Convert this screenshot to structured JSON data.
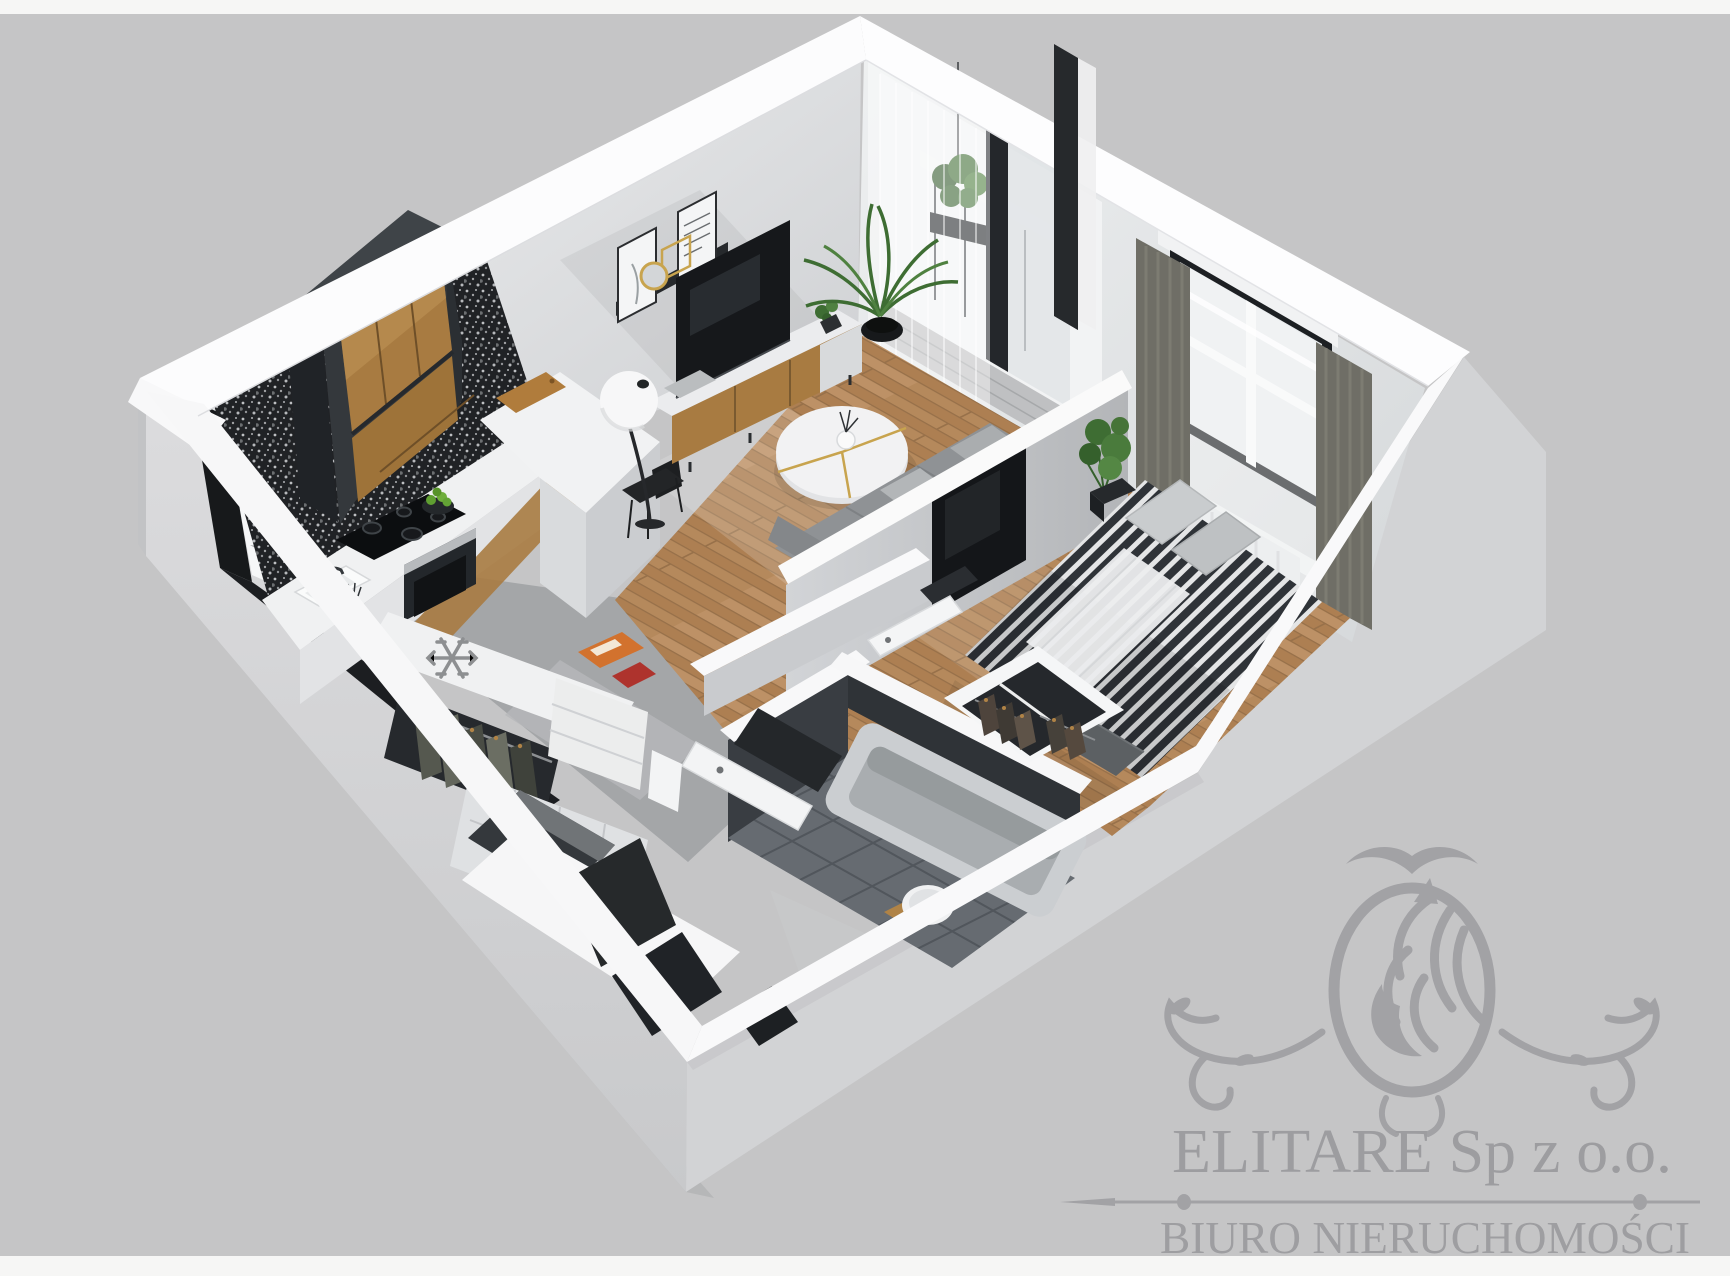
{
  "watermark": {
    "company": "ELITARE Sp z o.o.",
    "subtitle": "BIURO NIERUCHOMOŚCI",
    "emblem": "lion-crest-emblem",
    "text_color": "#97979a"
  },
  "scene": {
    "type": "3d-apartment-floor-plan-render",
    "view": "isometric-cutaway",
    "background_color": "#c5c5c6",
    "rooms": [
      {
        "name": "living-room-with-kitchenette",
        "floor": "oak-plank",
        "items": [
          "charcoal-oak-upper-cabinets",
          "patterned-tile-backsplash",
          "induction-cooktop",
          "built-in-oven",
          "kitchen-sink",
          "freezer-snowflake-marker",
          "kitchen-peninsula",
          "cutting-board",
          "fruit-bowl",
          "bar-chairs",
          "wall-shelf-with-posters",
          "round-gold-mirror",
          "tv",
          "tv-media-console",
          "sphere-floor-lamp",
          "round-coffee-table",
          "corner-sofa",
          "palm-plant",
          "balcony-door",
          "sheer-curtains"
        ]
      },
      {
        "name": "balcony",
        "floor": "gray-tile",
        "items": [
          "hanging-plant",
          "railing",
          "glass-door-frame"
        ]
      },
      {
        "name": "bedroom",
        "floor": "oak-plank",
        "items": [
          "double-bed-striped-duvet",
          "pillows",
          "white-folded-blanket",
          "foot-bench",
          "open-wardrobe-with-clothes",
          "wall-mounted-tv",
          "window-with-curtains",
          "monstera-plant",
          "radiator"
        ]
      },
      {
        "name": "bathroom",
        "floor": "dark-gray-tile",
        "items": [
          "bathtub",
          "round-washbasin",
          "wood-stool",
          "bathroom-door"
        ]
      },
      {
        "name": "hallway",
        "floor": "gray-screed",
        "items": [
          "open-wardrobe-with-clothes",
          "shelf-with-orange-box",
          "shelf-with-red-box",
          "storage-cabinets",
          "bedroom-door",
          "wall-openings"
        ]
      }
    ],
    "colors": {
      "wall_white": "#fbfbfc",
      "wall_exterior_gray": "#d4d5d7",
      "wood_floor": "#b5895c",
      "gray_floor": "#a4a6a8",
      "bath_tile": "#666b71",
      "dark_wall": "#393d42",
      "cabinet_charcoal": "#34383c",
      "cabinet_oak": "#a87b41",
      "sofa_gray": "#8f9295",
      "bed_stripe_dark": "#2f3338",
      "curtain_olive": "#6f6e66",
      "accent_gold": "#c8a44e",
      "plant_green": "#4a7b3c"
    },
    "icons": [
      "snowflake-icon",
      "lion-emblem-icon"
    ]
  }
}
